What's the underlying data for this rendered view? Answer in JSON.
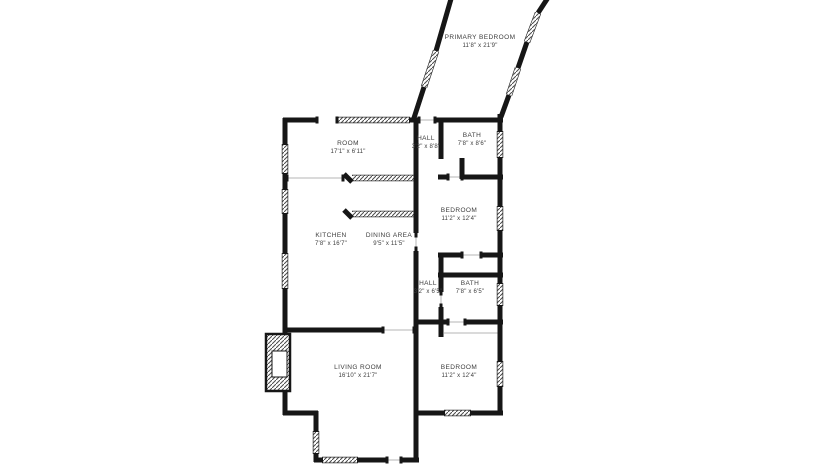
{
  "page": {
    "background": "#ffffff"
  },
  "floorplan": {
    "wall_color": "#161616",
    "window_hatch_color": "#4a4a4a",
    "label_color": "#3d3d3d",
    "rooms": [
      {
        "id": "primary-bedroom",
        "name": "PRIMARY BEDROOM",
        "dims": "11'8\" x 21'9\"",
        "x": 480,
        "y": 42
      },
      {
        "id": "room",
        "name": "ROOM",
        "dims": "17'1\" x 6'11\"",
        "x": 348,
        "y": 148
      },
      {
        "id": "hall-upper",
        "name": "HALL",
        "dims": "3'2\" x 8'8\"",
        "x": 426,
        "y": 143
      },
      {
        "id": "bath-upper",
        "name": "BATH",
        "dims": "7'8\" x 8'6\"",
        "x": 472,
        "y": 140
      },
      {
        "id": "bedroom-upper",
        "name": "BEDROOM",
        "dims": "11'2\" x 12'4\"",
        "x": 459,
        "y": 215
      },
      {
        "id": "kitchen",
        "name": "KITCHEN",
        "dims": "7'8\" x 16'7\"",
        "x": 331,
        "y": 240
      },
      {
        "id": "dining-area",
        "name": "DINING AREA",
        "dims": "9'5\" x 11'5\"",
        "x": 389,
        "y": 240
      },
      {
        "id": "hall-lower",
        "name": "HALL",
        "dims": "3'2\" x 6'5\"",
        "x": 428,
        "y": 288
      },
      {
        "id": "bath-lower",
        "name": "BATH",
        "dims": "7'8\" x 6'5\"",
        "x": 470,
        "y": 288
      },
      {
        "id": "living-room",
        "name": "LIVING ROOM",
        "dims": "16'10\" x 21'7\"",
        "x": 358,
        "y": 372
      },
      {
        "id": "bedroom-lower",
        "name": "BEDROOM",
        "dims": "11'2\" x 12'4\"",
        "x": 459,
        "y": 372
      }
    ]
  }
}
